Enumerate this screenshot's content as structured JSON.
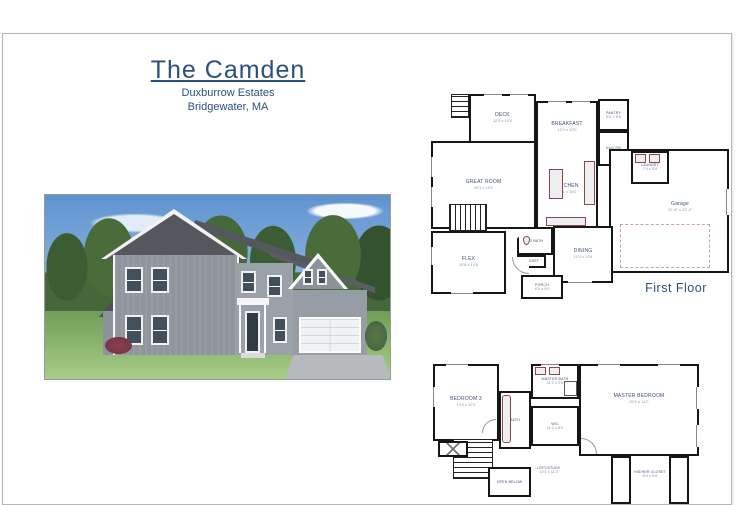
{
  "document": {
    "title": "The Camden",
    "subtitle": "Duxburrow Estates",
    "location": "Bridgewater, MA"
  },
  "first_floor": {
    "caption": "First Floor",
    "deck": {
      "name": "DECK",
      "dims": "12'0 x 10'0"
    },
    "breakfast": {
      "name": "BREAKFAST",
      "dims": "12'2 x 10'0"
    },
    "pantry": {
      "name": "PANTRY",
      "dims": "5'6 x 6'8"
    },
    "mud_room": {
      "name": "MUD RM"
    },
    "laundry": {
      "name": "LAUNDRY",
      "dims": "7'4 x 5'8"
    },
    "garage": {
      "name": "Garage",
      "dims": "21'-8\" x 22'-2\""
    },
    "great_room": {
      "name": "GREAT ROOM",
      "dims": "20'1 x 15'2"
    },
    "kitchen": {
      "name": "KITCHEN",
      "dims": "12'1 x 15'2"
    },
    "dining": {
      "name": "DINING",
      "dims": "12'2 x 13'4"
    },
    "flex": {
      "name": "FLEX",
      "dims": "10'8 x 12'6"
    },
    "half_bath": {
      "name": "1/2 BATH"
    },
    "closet": {
      "name": "CLOSET"
    },
    "porch": {
      "name": "PORCH",
      "dims": "6'4 x 5'0"
    }
  },
  "second_floor": {
    "bedroom3": {
      "name": "BEDROOM 3",
      "dims": "13'4 x 12'1"
    },
    "master_bath": {
      "name": "MASTER BATH",
      "dims": "11'2 x 9'6"
    },
    "bath": {
      "name": "BATH"
    },
    "wic": {
      "name": "WIC",
      "dims": "11'2 x 6'2"
    },
    "master_bedroom": {
      "name": "MASTER BEDROOM",
      "dims": "20'1 x 14'2"
    },
    "loft_study": {
      "name": "LOFT/STUDY",
      "dims": "14'4 x 11'2"
    },
    "open_below": {
      "name": "OPEN BELOW"
    },
    "his_her_closet": {
      "name": "HIS/HER CLOSET",
      "dims": "6'4 x 5'6"
    }
  },
  "colors": {
    "accent": "#2d4f7c",
    "wall": "#161616",
    "room_label": "#3d4e80",
    "dims_label": "#8a96b8",
    "teal_label": "#2e8b8b",
    "fixture": "#8b4a4a",
    "garage_dashed": "#c79ac7"
  }
}
